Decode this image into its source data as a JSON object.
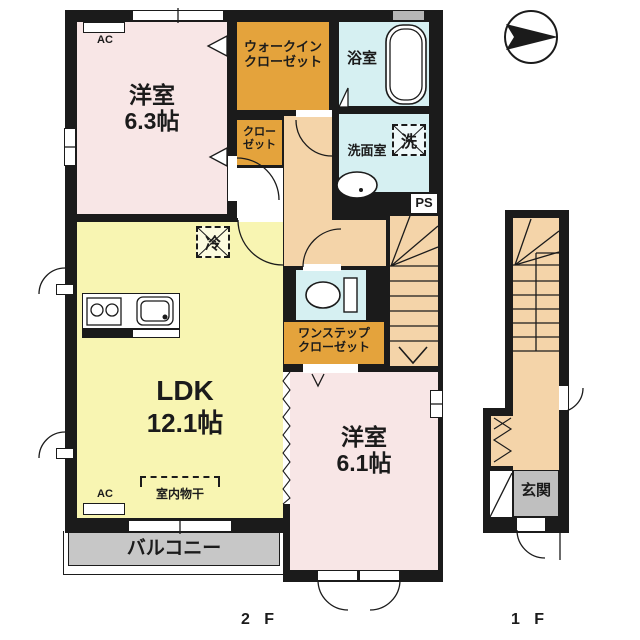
{
  "page": {
    "background": "#ffffff"
  },
  "colors": {
    "page_bg": "#ffffff",
    "wall": "#1b1b1b",
    "room_pink": "#f8e6e6",
    "closet_orange": "#e4a33c",
    "ldk_yellow": "#f8f5b2",
    "wet_blue": "#d6f0f2",
    "hall_peach": "#f4d4a9",
    "balcony_gray": "#c7c7c7",
    "entrance_gray": "#bfbfbf",
    "window_gray": "#b6b6b6"
  },
  "floor2": {
    "floor_label": "2 F",
    "western_room_63": {
      "name": "洋室",
      "area": "6.3帖"
    },
    "walk_in_closet": {
      "line1": "ウォークイン",
      "line2": "クローゼット"
    },
    "closet": {
      "line1": "クロー",
      "line2": "ゼット"
    },
    "bathroom": "浴室",
    "washroom": "洗面室",
    "washing_machine": "洗",
    "pipe_space": "PS",
    "refrigerator": "冷",
    "ldk": {
      "name": "LDK",
      "area": "12.1帖"
    },
    "one_step_closet": {
      "line1": "ワンステップ",
      "line2": "クローゼット"
    },
    "indoor_drying_rack": "室内物干",
    "ac_upper": "AC",
    "ac_lower": "AC",
    "western_room_61": {
      "name": "洋室",
      "area": "6.1帖"
    },
    "balcony": "バルコニー"
  },
  "floor1": {
    "floor_label": "1 F",
    "entrance": "玄関"
  }
}
